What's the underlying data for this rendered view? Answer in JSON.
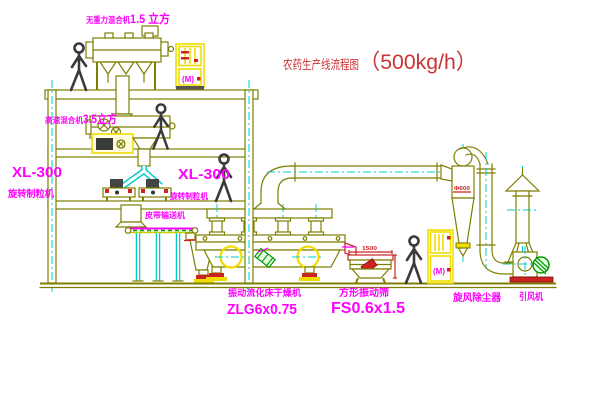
{
  "title": {
    "main": "农药生产线流程图",
    "capacity": "（500kg/h）"
  },
  "colors": {
    "line": "#7e7e00",
    "centerline": "#00cccc",
    "label": "#ff00ff",
    "title_red": "#cc3333",
    "highlight_yellow": "#f0dc00",
    "alert_red": "#cc2222",
    "motor_green": "#009900",
    "figure": "#3a3a3a",
    "background": "#ffffff"
  },
  "labels": {
    "top_mixer_name": "无重力混合机",
    "top_mixer_size": "1.5 立方",
    "mixer_2f_name": "高速混合机",
    "mixer_2f_size": "3.5立方",
    "granulator_left_model": "XL-300",
    "granulator_left_name": "旋转制粒机",
    "granulator_right_model": "XL-300",
    "granulator_right_name": "旋转制粒机",
    "belt_conveyor": "皮带输送机",
    "dryer_name": "振动流化床干燥机",
    "dryer_model": "ZLG6x0.75",
    "sieve_name": "方形振动筛",
    "sieve_model": "FS0.6x1.5",
    "cyclone_name": "旋风除尘器",
    "fan_name": "引风机"
  },
  "annotations": {
    "hoist_top_motor_mark": "(M)",
    "hoist_right_motor_mark": "(M)",
    "sieve_dim_length": "1500",
    "cyclone_dim": "Φ600"
  }
}
